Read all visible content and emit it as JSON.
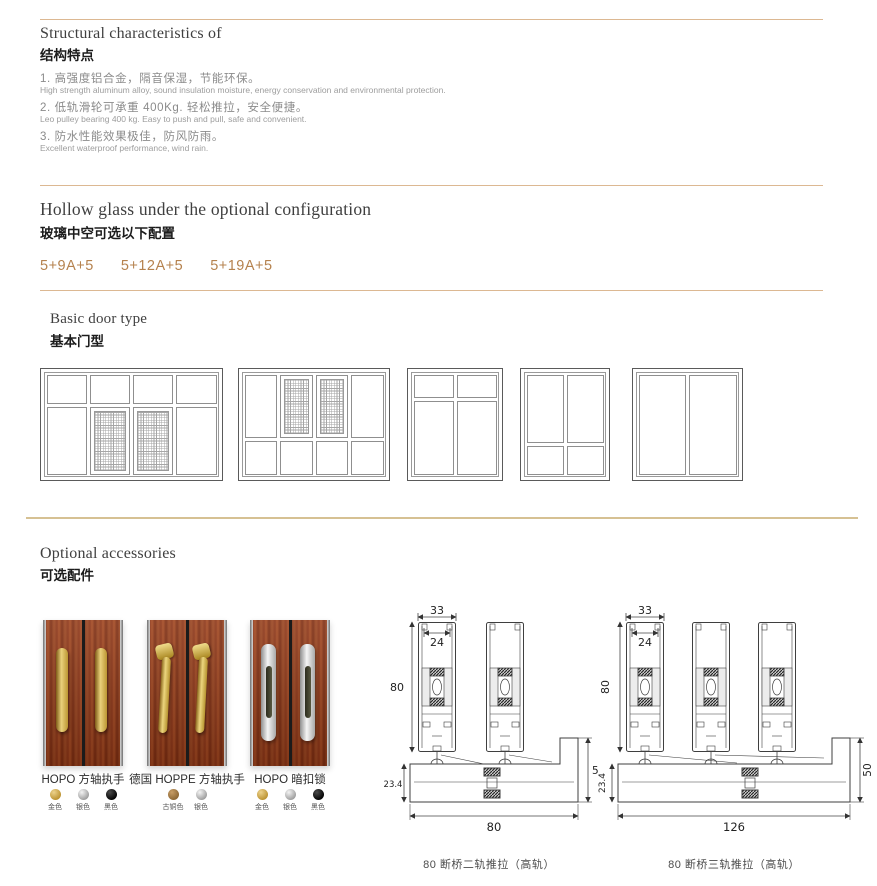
{
  "colors": {
    "divider": "#dcb892",
    "accent_text": "#b5824e",
    "gold": "#d2a74e",
    "silver": "#c4c4c4",
    "black": "#1a1a1a",
    "bronze": "#a87d4a"
  },
  "sections": {
    "structural": {
      "title_en": "Structural characteristics of",
      "title_cn": "结构特点",
      "items": [
        {
          "cn": "1. 高强度铝合金，隔音保湿，节能环保。",
          "en": "High strength aluminum alloy, sound insulation moisture, energy conservation and environmental protection."
        },
        {
          "cn": "2. 低轨滑轮可承重 400Kg. 轻松推拉，安全便捷。",
          "en": "Leo pulley bearing 400 kg. Easy to push and pull, safe and convenient."
        },
        {
          "cn": "3. 防水性能效果极佳，防风防雨。",
          "en": "Excellent waterproof performance, wind rain."
        }
      ]
    },
    "glass": {
      "title_en": "Hollow glass under the optional configuration",
      "title_cn": "玻璃中空可选以下配置",
      "options": [
        "5+9A+5",
        "5+12A+5",
        "5+19A+5"
      ]
    },
    "door_type": {
      "title_en": "Basic door type",
      "title_cn": "基本门型"
    },
    "accessories": {
      "title_en": "Optional accessories",
      "title_cn": "可选配件",
      "products": [
        {
          "name": "HOPO 方轴执手",
          "colors": [
            {
              "label": "金色",
              "hex": "#d2a74e"
            },
            {
              "label": "银色",
              "hex": "#c4c4c4"
            },
            {
              "label": "黑色",
              "hex": "#1a1a1a"
            }
          ]
        },
        {
          "name": "德国 HOPPE 方轴执手",
          "colors": [
            {
              "label": "古铜色",
              "hex": "#a87d4a"
            },
            {
              "label": "银色",
              "hex": "#c4c4c4"
            }
          ]
        },
        {
          "name": "HOPO 暗扣锁",
          "colors": [
            {
              "label": "金色",
              "hex": "#d2a74e"
            },
            {
              "label": "银色",
              "hex": "#c4c4c4"
            },
            {
              "label": "黑色",
              "hex": "#1a1a1a"
            }
          ]
        }
      ]
    },
    "profiles": [
      {
        "caption": "80 断桥二轨推拉（高轨）",
        "dims": {
          "top": "33",
          "glass": "24",
          "height": "80",
          "sill": "23.4",
          "right": "50",
          "width": "80"
        }
      },
      {
        "caption": "80 断桥三轨推拉（高轨）",
        "dims": {
          "top": "33",
          "glass": "24",
          "height": "80",
          "sill": "23.4",
          "right": "50",
          "width": "126"
        }
      }
    ]
  }
}
